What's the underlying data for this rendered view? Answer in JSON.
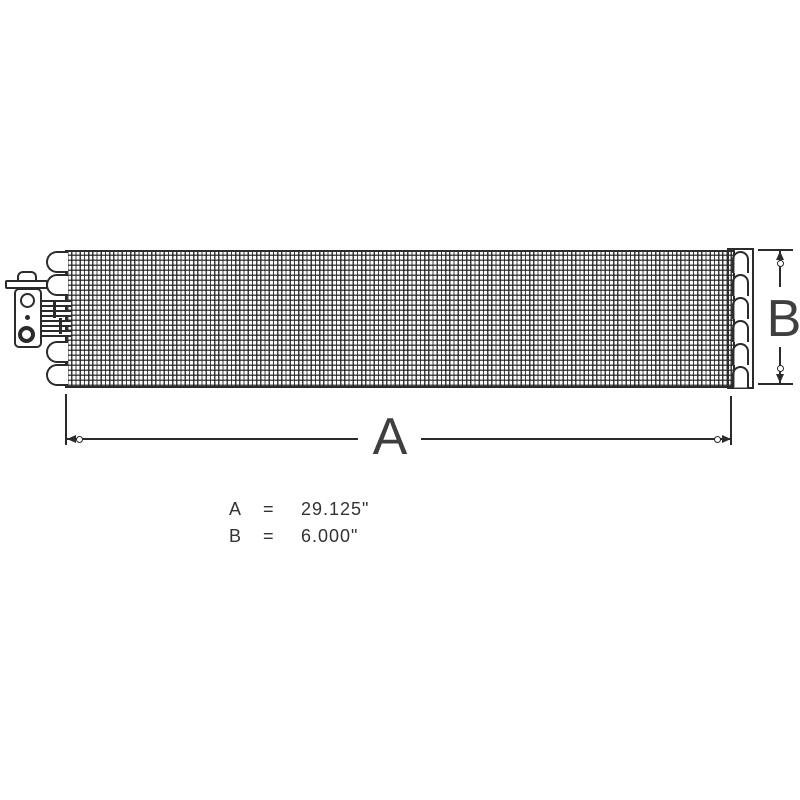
{
  "colors": {
    "line": "#2b2b2b",
    "background": "#ffffff",
    "text": "#333333"
  },
  "dims": {
    "a_label": "A",
    "b_label": "B"
  },
  "legend": {
    "rows": [
      {
        "label": "A",
        "eq": "=",
        "value": "29.125\""
      },
      {
        "label": "B",
        "eq": "=",
        "value": "6.000\""
      }
    ]
  }
}
